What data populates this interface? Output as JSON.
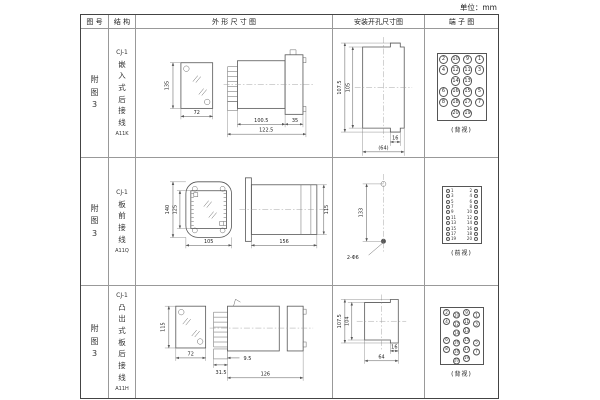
{
  "unit_label": "单位：mm",
  "headers": {
    "fig_no": "图 号",
    "structure": "结 构",
    "outline": "外 形 尺 寸 图",
    "install": "安装开孔尺寸图",
    "terminal": "端 子 图"
  },
  "rows": [
    {
      "fig_no": "附图3",
      "model": "CJ-1",
      "structure_desc": "嵌入式后接线",
      "code": "A11K",
      "outline": {
        "height": "135",
        "width": "72",
        "depth_body": "100.5",
        "flange": "35",
        "depth_total": "122.5"
      },
      "install": {
        "dim_outer": "107.5",
        "dim_inner": "105",
        "dim_w1": "16",
        "dim_w2": "(64)"
      },
      "terminal": {
        "label": "(背视)",
        "layout": "grid",
        "rows": [
          [
            "2",
            "10",
            "9",
            "1"
          ],
          [
            "4",
            "12",
            "11",
            "3"
          ],
          [
            "",
            "14",
            "13",
            ""
          ],
          [
            "6",
            "16",
            "15",
            "5"
          ],
          [
            "8",
            "18",
            "17",
            "7"
          ],
          [
            "",
            "20",
            "19",
            ""
          ]
        ]
      }
    },
    {
      "fig_no": "附图3",
      "model": "CJ-1",
      "structure_desc": "板前接线",
      "code": "A11Q",
      "outline": {
        "height_outer": "140",
        "height_inner": "125",
        "width": "105",
        "depth": "156",
        "side_height": "115"
      },
      "install": {
        "dim_v": "133",
        "hole_label": "2-Φ6"
      },
      "terminal": {
        "label": "(前视)",
        "layout": "dual",
        "left": [
          "1",
          "3",
          "5",
          "7",
          "9",
          "11",
          "13",
          "15",
          "17",
          "19"
        ],
        "right": [
          "2",
          "4",
          "6",
          "8",
          "10",
          "12",
          "14",
          "16",
          "18",
          "20"
        ]
      }
    },
    {
      "fig_no": "附图3",
      "model": "CJ-1",
      "structure_desc": "凸出式板后接线",
      "code": "A11H",
      "outline": {
        "height": "115",
        "width": "72",
        "dim_a": "31.5",
        "dim_b": "9.5",
        "depth_total": "126"
      },
      "install": {
        "dim_outer": "107.5",
        "dim_inner": "104",
        "dim_w1": "16",
        "dim_w2": "64"
      },
      "terminal": {
        "label": "(背视)",
        "layout": "stagger",
        "rows": [
          [
            "2",
            "10",
            "9",
            "1"
          ],
          [
            "4",
            "12",
            "11",
            "3"
          ],
          [
            "",
            "14",
            "13",
            ""
          ],
          [
            "6",
            "16",
            "15",
            "5"
          ],
          [
            "8",
            "18",
            "17",
            "7"
          ],
          [
            "",
            "20",
            "19",
            ""
          ]
        ]
      }
    }
  ]
}
